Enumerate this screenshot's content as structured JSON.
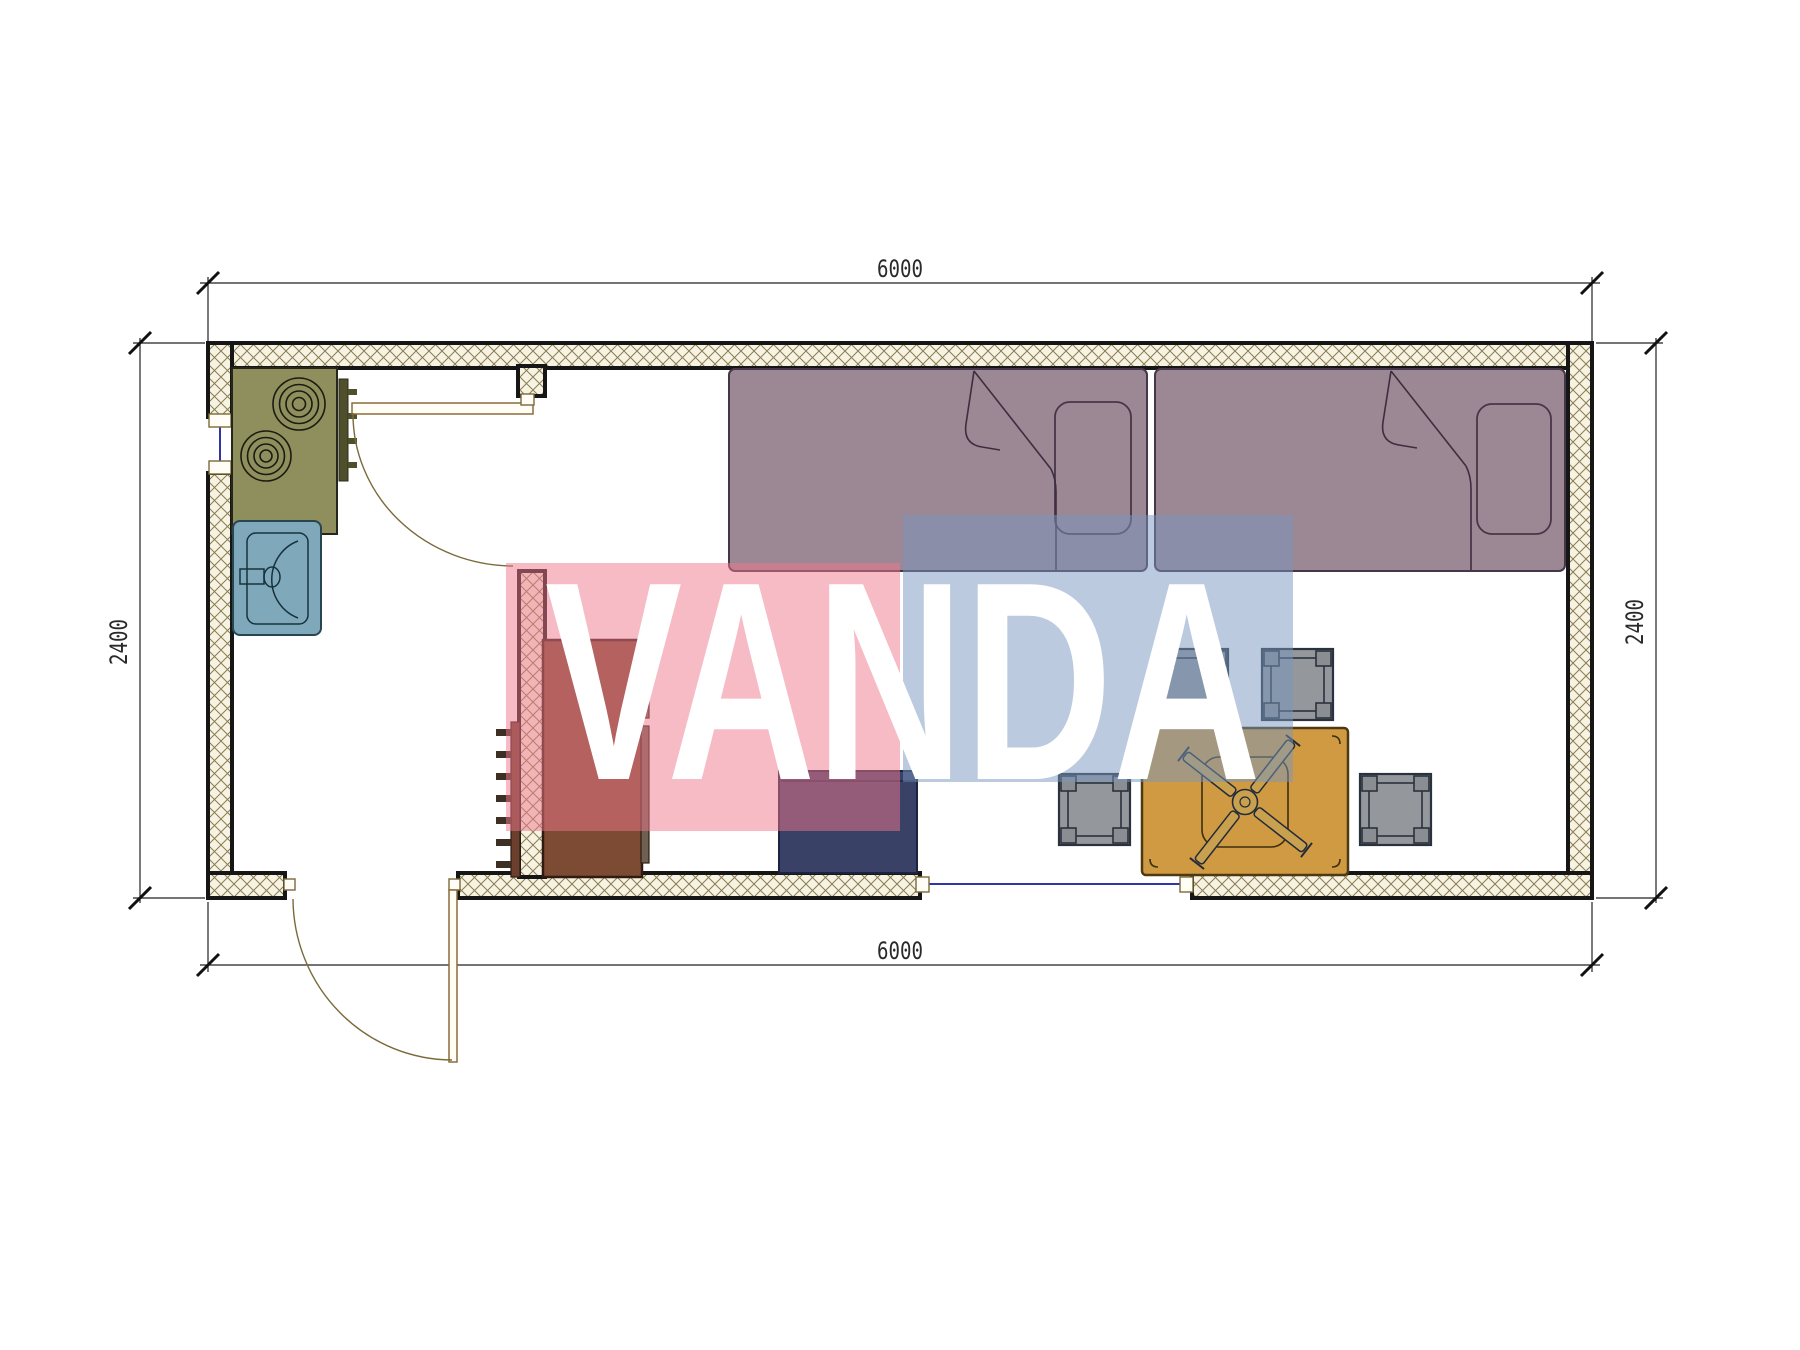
{
  "page": {
    "type": "architectural-floor-plan",
    "background": "#ffffff"
  },
  "watermark": {
    "text": "VANDA",
    "text_color": "#ffffff",
    "pink_color": "#ed788c",
    "blue_color": "#7896be"
  },
  "dimensions": {
    "top": "6000",
    "bottom": "6000",
    "left": "2400",
    "right": "2400"
  },
  "plan": {
    "wall_hatch_bg": "#f7f3e2",
    "wall_hatch_line": "#8a7c52",
    "wall_outline": "#161616",
    "door_color": "#8a6d3b",
    "window_color": "#3333aa"
  },
  "furniture": [
    {
      "name": "stove-cooktop",
      "color": "#8f8f5e"
    },
    {
      "name": "sink",
      "color": "#7fa8ba"
    },
    {
      "name": "single-bed-left",
      "color": "#9c8795"
    },
    {
      "name": "single-bed-right",
      "color": "#9c8795"
    },
    {
      "name": "wardrobe",
      "color": "#7d4a33"
    },
    {
      "name": "ladder",
      "color": "#6b3f2c"
    },
    {
      "name": "nightstand",
      "color": "#3a4166"
    },
    {
      "name": "dining-table",
      "color": "#d09a42"
    },
    {
      "name": "table-fan-symbol",
      "color": "#c9a14e"
    },
    {
      "name": "stool",
      "color": "#94979b"
    }
  ]
}
